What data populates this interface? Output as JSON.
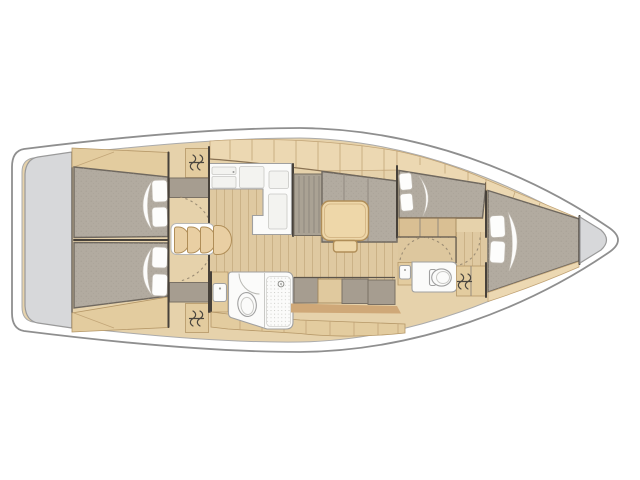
{
  "diagram": {
    "type": "sailboat-interior-floor-plan",
    "orientation": {
      "bow": "right",
      "stern": "left"
    },
    "colors": {
      "background": "#ffffff",
      "hull_fill": "#ffffff",
      "hull_stroke": "#8f8f8f",
      "inner_stroke": "#ababab",
      "interior_wood": "#e6d2ab",
      "cabinet_wood": "#ecd8b2",
      "cabinet_wood_alt": "#e3cc9f",
      "cabinet_edge": "#8a7354",
      "floor_wood": "#dfc9a1",
      "floor_plank_line": "#cbb287",
      "upholstery_gray": "#b2aba0",
      "upholstery_stroke": "#6f685f",
      "platform_gray": "#d7d8da",
      "platform_stroke": "#9a9a9a",
      "dark_cabinet_gray": "#a69d90",
      "white_fixture": "#fbfbfa",
      "fixture_stroke": "#a0a0a0",
      "table_wood": "#eed7a9",
      "table_stroke": "#b08e58",
      "bulkhead": "#47413a",
      "door_arc": "#9b8c74",
      "icon_stroke": "#4a463f",
      "trim_band": "#cfa878"
    },
    "elements": [
      "hull",
      "swim-platform",
      "aft-cabin-port-berth",
      "aft-cabin-starboard-berth",
      "hanging-locker-port",
      "hanging-locker-starboard",
      "companionway-steps",
      "galley-counter",
      "galley-sink",
      "galley-stove",
      "salon-settee",
      "salon-table",
      "aft-head",
      "aft-head-sink",
      "aft-head-toilet",
      "aft-head-shower",
      "mid-cabin-berth",
      "dressing-area",
      "forward-head",
      "forward-head-sink",
      "forward-head-toilet",
      "forward-hanging-locker",
      "forward-cabin-berth",
      "anchor-locker"
    ]
  }
}
